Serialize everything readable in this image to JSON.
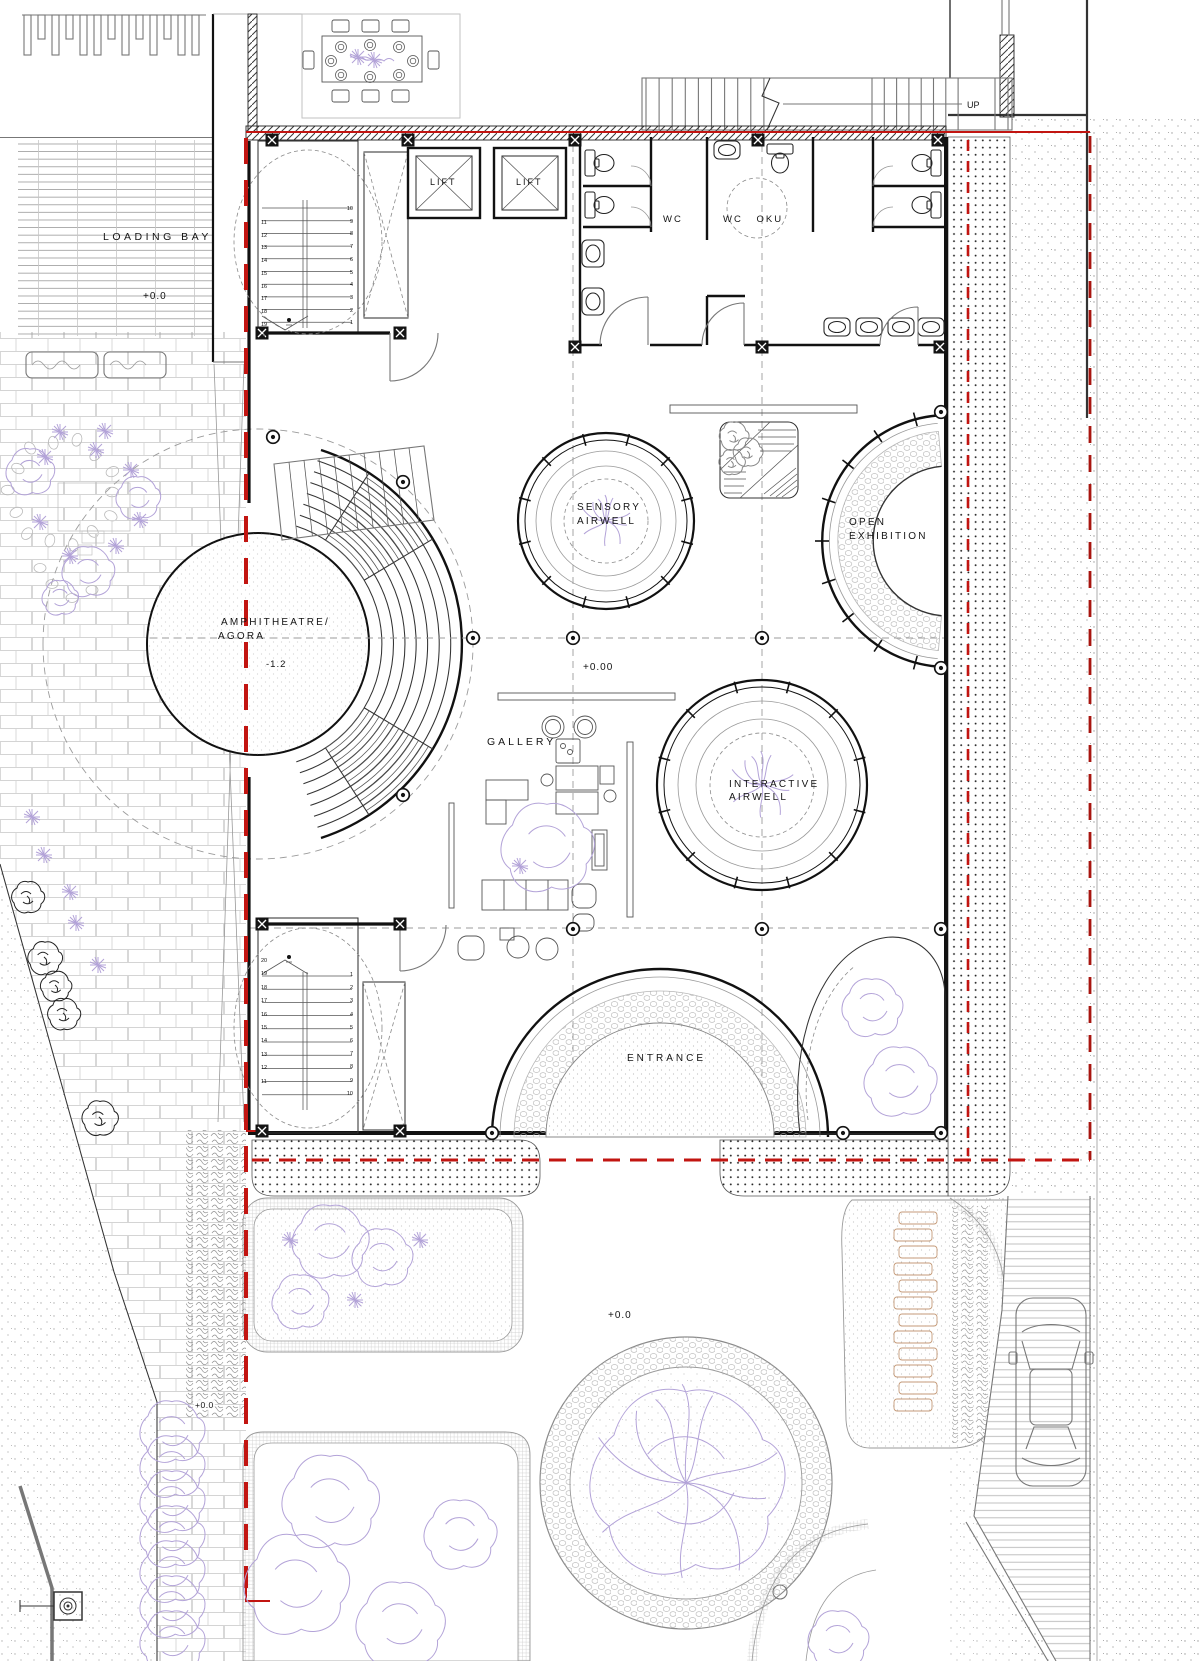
{
  "labels": {
    "loading_bay": "LOADING BAY",
    "loading_level": "+0.0",
    "lift_left": "LIFT",
    "lift_right": "LIFT",
    "wc": "WC",
    "wc_oku": "WC OKU",
    "up": "UP",
    "sensory_1": "SENSORY",
    "sensory_2": "AIRWELL",
    "open_1": "OPEN",
    "open_2": "EXHIBITION",
    "amphitheatre_1": "AMPHITHEATRE/",
    "amphitheatre_2": "AGORA",
    "amphitheatre_level": "-1.2",
    "hall_level": "+0.00",
    "gallery": "GALLERY",
    "interactive_1": "INTERACTIVE",
    "interactive_2": "AIRWELL",
    "entrance": "ENTRANCE",
    "garden_level": "+0.0",
    "path_level": "+0.0"
  },
  "stairs": {
    "upper": {
      "left": [
        "11",
        "12",
        "13",
        "14",
        "15",
        "16",
        "17",
        "18",
        "19",
        "20"
      ],
      "right": [
        "10",
        "9",
        "8",
        "7",
        "6",
        "5",
        "4",
        "3",
        "2",
        "1"
      ]
    },
    "lower": {
      "left": [
        "20",
        "19",
        "18",
        "17",
        "16",
        "15",
        "14",
        "13",
        "12",
        "11"
      ],
      "right": [
        "1",
        "2",
        "3",
        "4",
        "5",
        "6",
        "7",
        "8",
        "9",
        "10"
      ]
    }
  },
  "colors": {
    "boundary_red": "#c21511",
    "boundary_red_dark": "#a8150f",
    "plant_purple": "#b3a3d8",
    "plank_tan": "#c49a78"
  }
}
